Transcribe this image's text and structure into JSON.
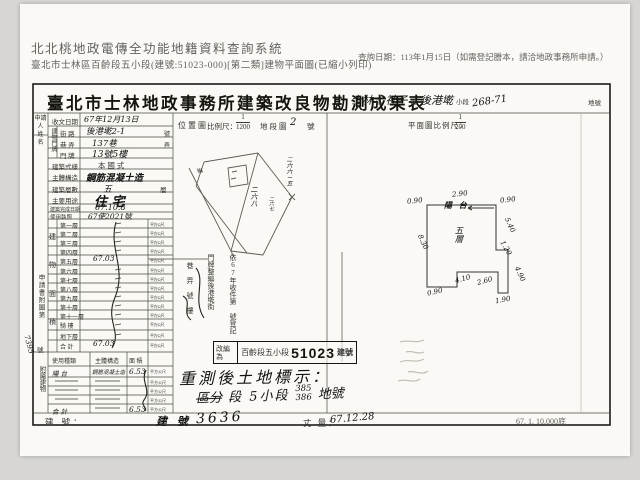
{
  "header": {
    "system_title": "北北桃地政電傳全功能地籍資料查詢系統",
    "subtitle": "臺北市士林區百齡段五小段(建號:51023-000)[第二類]建物平面圖(已縮小列印)",
    "query_date": "查詢日期：113年1月15日（如需登記謄本，請洽地政事務所申請。）"
  },
  "form": {
    "title": "臺北市士林地政事務所建築改良物勘測成果表",
    "land_mark": {
      "district": "士林",
      "district_label": "區",
      "section": "社子",
      "section_label": "段",
      "subsection": "後港墘",
      "subsection_label": "小段",
      "lot": "268-71",
      "lot_label": "地號"
    },
    "applicant": {
      "line1": "申請人",
      "line2": "姓 名"
    },
    "address_group_label": "建物門牌",
    "basic_fields": [
      {
        "label": "收文日期",
        "value": "67年12月13日",
        "unit": ""
      },
      {
        "label": "街 路",
        "value": "後港墘2-1",
        "unit": "號"
      },
      {
        "label": "巷 弄",
        "value": "137巷",
        "unit": "弄"
      },
      {
        "label": "門 牌",
        "value": "13號5樓",
        "unit": ""
      },
      {
        "label": "建築式樣",
        "value": "本 國 式",
        "unit": ""
      },
      {
        "label": "主體構造",
        "value": "鋼筋混凝土造",
        "unit": ""
      },
      {
        "label": "建築層數",
        "value": "五",
        "unit": "層"
      },
      {
        "label": "主要用途",
        "value": "住 宅",
        "unit": ""
      },
      {
        "label": "建築完成日期",
        "value": "67.10.8",
        "unit": ""
      },
      {
        "label": "使用執照",
        "value": "67使2021號",
        "unit": ""
      }
    ],
    "area_table": {
      "group_label": [
        "建",
        "物",
        "面",
        "積"
      ],
      "unit": "平方公尺",
      "rows": [
        {
          "label": "第一層",
          "value": ""
        },
        {
          "label": "第二層",
          "value": ""
        },
        {
          "label": "第三層",
          "value": ""
        },
        {
          "label": "第四層",
          "value": ""
        },
        {
          "label": "第五層",
          "value": "67.03"
        },
        {
          "label": "第六層",
          "value": ""
        },
        {
          "label": "第七層",
          "value": ""
        },
        {
          "label": "第八層",
          "value": ""
        },
        {
          "label": "第九層",
          "value": ""
        },
        {
          "label": "第十層",
          "value": ""
        },
        {
          "label": "第十一層",
          "value": ""
        },
        {
          "label": "騎 樓",
          "value": ""
        },
        {
          "label": "地下層",
          "value": ""
        },
        {
          "label": "合 計",
          "value": "67.03"
        }
      ]
    },
    "side_note": {
      "text": "申請書附圖第",
      "number": "7395",
      "suffix": "號"
    },
    "annex_table": {
      "group_label": "附屬建物",
      "headers": [
        "使用種類",
        "主體構造",
        "面 積"
      ],
      "unit": "平方公尺",
      "rows": [
        {
          "use": "陽 台",
          "structure": "鋼筋混凝土造",
          "area": "6.53"
        },
        {
          "use": "",
          "structure": "",
          "area": ""
        },
        {
          "use": "",
          "structure": "",
          "area": ""
        },
        {
          "use": "",
          "structure": "",
          "area": ""
        },
        {
          "use": "合 計",
          "structure": "",
          "area": "6.53"
        }
      ]
    },
    "bottom": {
      "build_label": "建 號：",
      "build_no_prefix": "建 號",
      "build_no": "3636",
      "survey_label": "丈 量：",
      "survey_value": "67.12.28",
      "print_code": "67. 1. 10,000底"
    }
  },
  "location": {
    "panel_label": "位置圖",
    "scale_label": "比例尺：",
    "scale_num": "1",
    "scale_den": "1200",
    "map_label": "地段圖",
    "map_no": "2",
    "map_no_suffix": "號",
    "parcels": [
      "二六六－五",
      "二六八",
      "二六七"
    ],
    "road_label": "道"
  },
  "plan": {
    "header_label": "平面圖比例尺：",
    "scale_num": "1",
    "scale_den": "200",
    "balcony": "陽 台",
    "floor_label": "五層",
    "dims": {
      "top": "2.90",
      "top_left": "0.90",
      "top_right": "0.90",
      "right_upper": "5.40",
      "right_mid": "1.20",
      "right_lower": "4.90",
      "bottom_right": "1.90",
      "bottom_mid": "2.60",
      "bottom_mid2": "4.10",
      "bottom_left": "0.90",
      "left": "8.30"
    }
  },
  "stamps": {
    "col_register": "依67年收件第 號登記",
    "col_renumber": "門牌整編後港墘街",
    "col_lane": "巷 弄 號 樓",
    "box_prefix": "改編為",
    "box_section": "百齡段五小段",
    "box_number": "51023",
    "box_suffix": "建號",
    "resurvey_line1": "重測後土地標示：",
    "resurvey_prefix": "區分",
    "resurvey_mid": "段 5小段",
    "resurvey_no_top": "385",
    "resurvey_no_bottom": "386",
    "resurvey_suffix": "地號"
  }
}
